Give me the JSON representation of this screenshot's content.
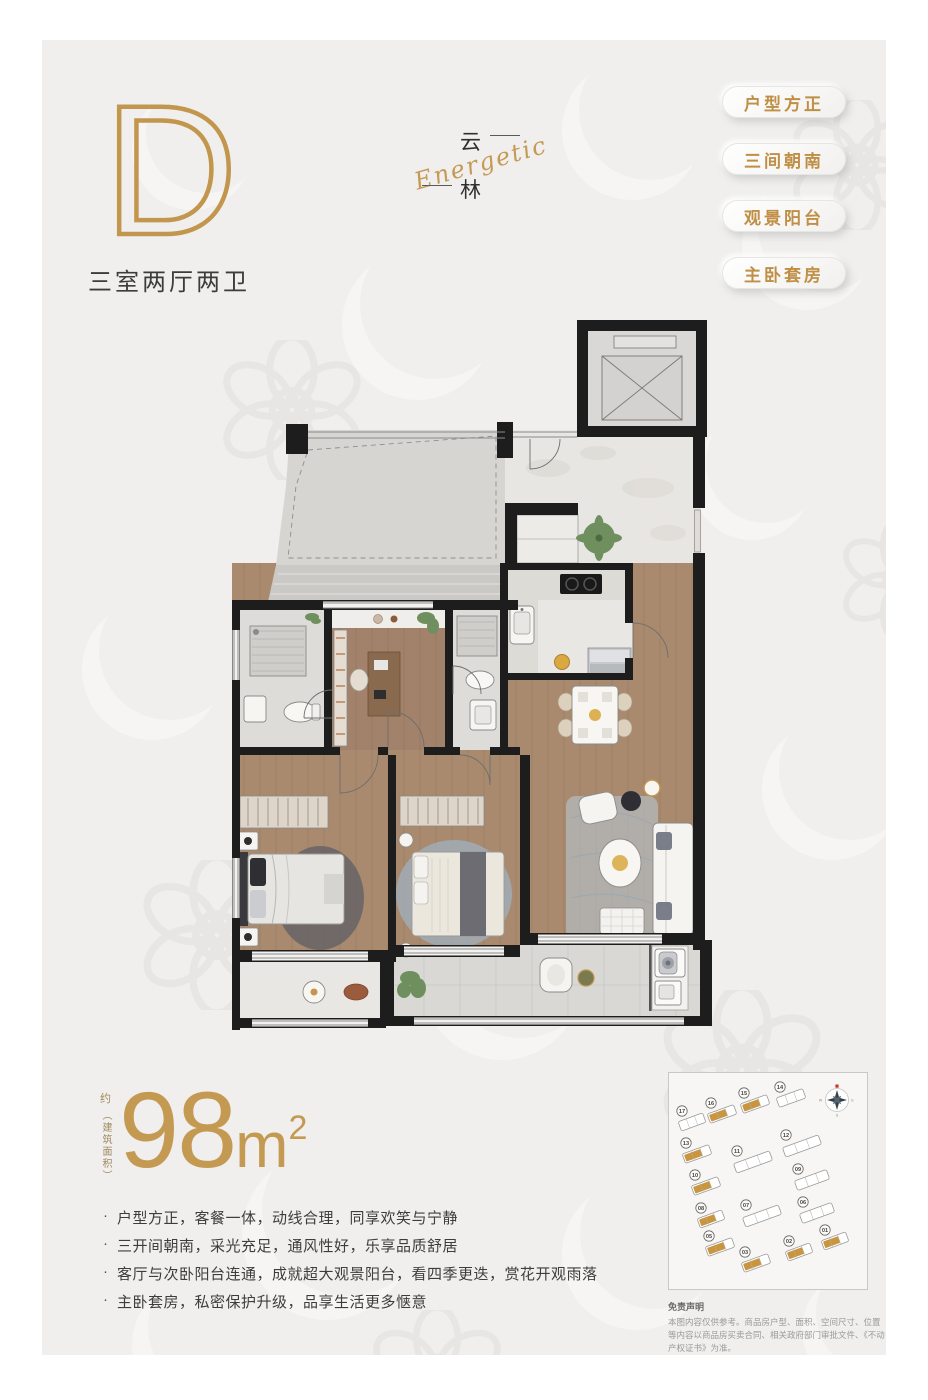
{
  "unit": {
    "letter": "D",
    "layout_label": "三室两厅两卫"
  },
  "logo": {
    "char_top": "云",
    "char_bottom": "林",
    "script": "Energetic"
  },
  "badges": [
    {
      "label": "户型方正"
    },
    {
      "label": "三间朝南"
    },
    {
      "label": "观景阳台"
    },
    {
      "label": "主卧套房"
    }
  ],
  "area": {
    "approx": "约",
    "paren_label": "（建筑面积）",
    "value": "98",
    "unit": "m",
    "sup": "2"
  },
  "highlights": [
    "户型方正，客餐一体，动线合理，同享欢笑与宁静",
    "三开间朝南，采光充足，通风性好，乐享品质舒居",
    "客厅与次卧阳台连通，成就超大观景阳台，看四季更迭，赏花开观雨落",
    "主卧套房，私密保护升级，品享生活更多惬意"
  ],
  "siteplan": {
    "compass": {
      "east": "E",
      "south": "S",
      "west": "W"
    },
    "highlight_color": "#c9963f",
    "buildings": [
      {
        "num": "17",
        "x": 23,
        "y": 49,
        "w": 26,
        "gold": false
      },
      {
        "num": "16",
        "x": 53,
        "y": 41,
        "w": 28,
        "gold": true
      },
      {
        "num": "15",
        "x": 86,
        "y": 31,
        "w": 28,
        "gold": true
      },
      {
        "num": "14",
        "x": 122,
        "y": 25,
        "w": 28,
        "gold": false
      },
      {
        "num": "13",
        "x": 28,
        "y": 81,
        "w": 28,
        "gold": true
      },
      {
        "num": "11",
        "x": 84,
        "y": 89,
        "w": 38,
        "gold": false
      },
      {
        "num": "12",
        "x": 133,
        "y": 73,
        "w": 38,
        "gold": false
      },
      {
        "num": "10",
        "x": 37,
        "y": 113,
        "w": 28,
        "gold": true
      },
      {
        "num": "09",
        "x": 143,
        "y": 107,
        "w": 34,
        "gold": false
      },
      {
        "num": "08",
        "x": 42,
        "y": 146,
        "w": 26,
        "gold": true
      },
      {
        "num": "07",
        "x": 93,
        "y": 143,
        "w": 38,
        "gold": false
      },
      {
        "num": "06",
        "x": 148,
        "y": 140,
        "w": 34,
        "gold": false
      },
      {
        "num": "05",
        "x": 51,
        "y": 174,
        "w": 28,
        "gold": true
      },
      {
        "num": "03",
        "x": 87,
        "y": 190,
        "w": 28,
        "gold": true
      },
      {
        "num": "02",
        "x": 130,
        "y": 179,
        "w": 26,
        "gold": true
      },
      {
        "num": "01",
        "x": 166,
        "y": 168,
        "w": 26,
        "gold": true
      }
    ]
  },
  "disclaimer": {
    "title": "免责声明",
    "body": "本图内容仅供参考。商品房户型、面积、空间尺寸、位置等内容以商品房买卖合同、相关政府部门审批文件、《不动产权证书》为准。"
  },
  "colors": {
    "gold": "#c2964d",
    "wall": "#1d1d1d",
    "panel": "#f0efee"
  }
}
